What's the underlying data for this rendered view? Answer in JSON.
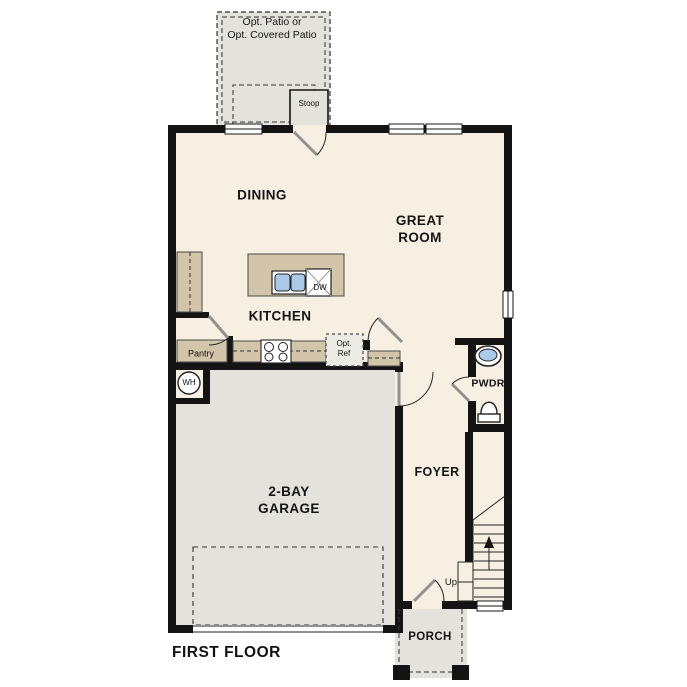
{
  "floor_plan": {
    "title": "FIRST FLOOR",
    "labels": {
      "patio": "Opt. Patio or\nOpt. Covered Patio",
      "stoop": "Stoop",
      "dining": "DINING",
      "great_room": "GREAT\nROOM",
      "kitchen": "KITCHEN",
      "pantry": "Pantry",
      "opt_ref": "Opt.\nRef",
      "dishwasher": "DW",
      "water_heater": "WH",
      "powder_room": "PWDR",
      "foyer": "FOYER",
      "stairs_direction": "Up",
      "garage": "2-BAY\nGARAGE",
      "porch": "PORCH"
    },
    "colors": {
      "wall": "#141414",
      "interior_floor": "#f7efe2",
      "cabinetry": "#d3c5a9",
      "exterior_concrete": "#e4e2dd",
      "fixture_blue": "#abc9e8"
    }
  }
}
